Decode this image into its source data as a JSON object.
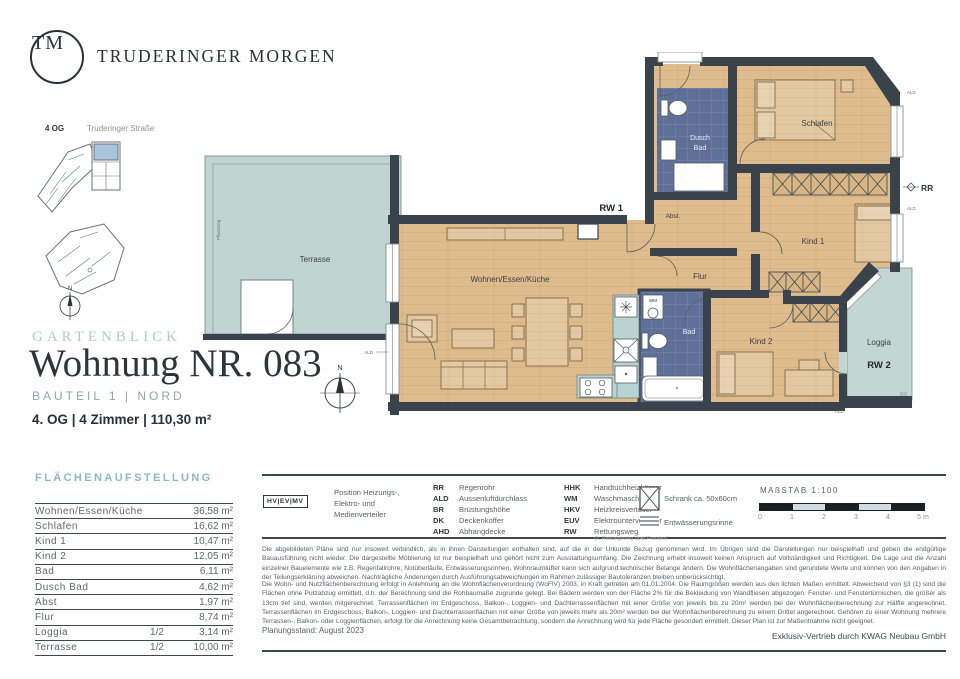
{
  "brand": {
    "logo_initials": "TM",
    "name": "TRUDERINGER MORGEN"
  },
  "site_plan": {
    "floor_label": "4 OG",
    "street_label": "Truderinger Straße",
    "compass": "N"
  },
  "title_block": {
    "project_name": "GARTENBLICK",
    "title": "Wohnung NR. 083",
    "subtitle": "BAUTEIL 1 | NORD",
    "summary": "4. OG | 4 Zimmer | 110,30 m²"
  },
  "area_table": {
    "heading": "FLÄCHENAUFSTELLUNG",
    "rows": [
      {
        "label": "Wohnen/Essen/Küche",
        "fraction": "",
        "value": "36,58 m²"
      },
      {
        "label": "Schlafen",
        "fraction": "",
        "value": "16,62 m²"
      },
      {
        "label": "Kind 1",
        "fraction": "",
        "value": "10,47 m²"
      },
      {
        "label": "Kind 2",
        "fraction": "",
        "value": "12,05 m²"
      },
      {
        "label": "Bad",
        "fraction": "",
        "value": "6,11 m²"
      },
      {
        "label": "Dusch Bad",
        "fraction": "",
        "value": "4,62 m²"
      },
      {
        "label": "Abst",
        "fraction": "",
        "value": "1,97 m²"
      },
      {
        "label": "Flur",
        "fraction": "",
        "value": "8,74 m²"
      },
      {
        "label": "Loggia",
        "fraction": "1/2",
        "value": "3,14 m²"
      },
      {
        "label": "Terrasse",
        "fraction": "1/2",
        "value": "10,00 m²"
      }
    ]
  },
  "legend": {
    "hv_box": "HV|EV|MV",
    "hv_label_line1": "Position Heizungs-,",
    "hv_label_line2": "Elektro- und",
    "hv_label_line3": "Medienverteiler",
    "col1": [
      {
        "abbr": "RR",
        "term": "Regenrohr"
      },
      {
        "abbr": "ALD",
        "term": "Aussenluftdurchlass"
      },
      {
        "abbr": "BR",
        "term": "Brüstungshöhe"
      },
      {
        "abbr": "DK",
        "term": "Deckenkoffer"
      },
      {
        "abbr": "AHD",
        "term": "Abhangdecke"
      }
    ],
    "col2": [
      {
        "abbr": "HHK",
        "term": "Handtuchheizkörper"
      },
      {
        "abbr": "WM",
        "term": "Waschmaschine"
      },
      {
        "abbr": "HKV",
        "term": "Heizkreisverteiler"
      },
      {
        "abbr": "EUV",
        "term": "Elektrounterverteiler"
      },
      {
        "abbr": "RW",
        "term": "Rettungsweg"
      }
    ],
    "rw_note": "(2. Rettungsweg über Fenster)",
    "schrank_label": "Schrank ca. 50x60cm",
    "rinne_label": "Entwässerungsrinne"
  },
  "scale_bar": {
    "label": "MAßSTAB 1:100",
    "ticks": [
      "0",
      "1",
      "2",
      "3",
      "4",
      "5 m"
    ]
  },
  "floor_plan": {
    "rooms": {
      "wohnen": "Wohnen/Essen/Küche",
      "schlafen": "Schlafen",
      "kind1": "Kind 1",
      "kind2": "Kind 2",
      "bad": "Bad",
      "dusch_line1": "Dusch",
      "dusch_line2": "Bad",
      "abst": "Abst.",
      "flur": "Flur",
      "loggia": "Loggia",
      "terrasse": "Terrasse"
    },
    "annotations": {
      "rw1": "RW 1",
      "rw2": "RW 2",
      "rr": "RR",
      "ald": "ALD",
      "wm": "WM",
      "compass": "N",
      "planter": "Pflanztrog"
    }
  },
  "disclaimer": {
    "paragraph1": "Die abgebildeten Pläne sind nur insoweit verbindlich, als in ihnen Darstellungen enthalten sind, auf die in der Urkunde Bezug genommen wird. Im Übrigen sind die Darstellungen nur beispielhaft und geben die endgültige Bauausführung nicht wieder. Die dargestellte Möblierung ist nur beispielhaft und gehört nicht zum Ausstattungsumfang. Die Zeichnung erhebt insoweit keinen Anspruch auf Vollständigkeit und Richtigkeit. Die Lage und die Anzahl einzelner Bauelemente wie z.B. Regenfallrohre, Notüberläufe, Entwässerungsrinnen, Wohnraumlüfter kann sich aufgrund technischer Belange ändern. Die Wohnflächenangaben sind gerundete Werte und können von den Angaben in der Teilungserklärung abweichen. Nachträgliche Änderungen durch Ausführungsabweichungen im Rahmen zulässiger Bautoleranzen bleiben unberücksichtigt.",
    "paragraph2": "Die Wohn- und Nutzflächenberechnung erfolgt in Anlehnung an die Wohnflächenverordnung (WoFlV) 2003, in Kraft getreten am 01.01.2004. Die Raumgrößen werden aus den lichten Maßen ermittelt. Abweichend von §3 (1) sind die Flächen ohne Putzabzug ermittelt, d.h. der Berechnung sind die Rohbaumaße zugrunde gelegt. Bei Bädern werden von der Fläche 2% für die Bekleidung von Wandfliesen abgezogen. Fenster- und Fenstertürnischen, die größer als 13cm tief sind, werden mitgerechnet. Terrassenflächen im Erdgeschoss, Balkon-, Loggien- und Dachterrassenflächen mit einer Größe von jeweils bis zu 20m² werden bei der Wohnflächenberechnung zur Hälfte angerechnet. Terrassenflächen im Erdgeschoss, Balkon-, Loggien- und Dachterrassenflächen mit einer Größe von jeweils mehr als 20m² werden bei der Wohnflächenberechnung zu einem Drittel angerechnet. Gehören zu einer Wohnung mehrere Terrassen-, Balkon- oder Loggienflächen, erfolgt für die Anrechnung keine Gesamtbetrachtung, sondern die Anrechnung wird für jede Fläche gesondert ermittelt. Dieser Plan ist zur Maßentnahme nicht geeignet."
  },
  "footer": {
    "planning_status": "Planungsstand: August 2023",
    "distribution": "Exklusiv-Vertrieb durch KWAG Neubau GmbH"
  },
  "colors": {
    "accent_heading": "#8fb6c8",
    "wall": "#3a424b",
    "wood": "#dfbc8d",
    "bath_blue": "#5e7098",
    "terrace_teal": "#c0d4d1"
  }
}
